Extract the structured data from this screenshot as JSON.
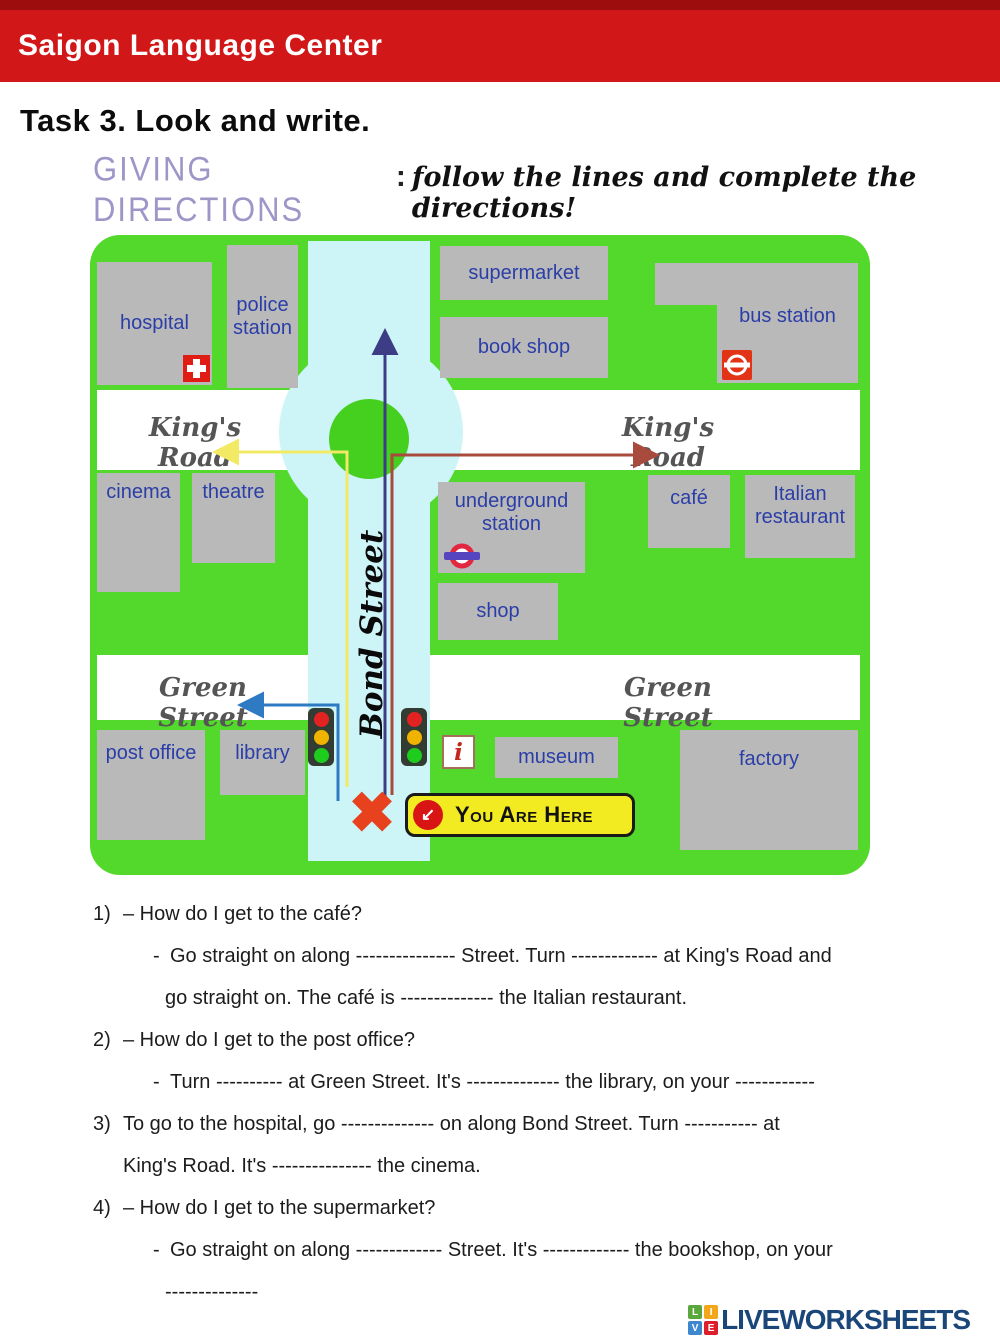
{
  "header": {
    "school_name": "Saigon Language Center"
  },
  "task": {
    "title": "Task 3. Look and write."
  },
  "intro": {
    "heading": "GIVING DIRECTIONS",
    "colon": ":",
    "script": "follow the lines and complete the directions!"
  },
  "map": {
    "streets": {
      "kings_road": "King's Road",
      "green_street": "Green Street",
      "bond_street": "Bond Street"
    },
    "buildings": {
      "hospital": "hospital",
      "police_station": "police station",
      "supermarket": "supermarket",
      "book_shop": "book shop",
      "bus_station": "bus station",
      "cinema": "cinema",
      "theatre": "theatre",
      "underground_station": "underground station",
      "shop": "shop",
      "cafe": "café",
      "italian_restaurant": "Italian restaurant",
      "post_office": "post office",
      "library": "library",
      "museum": "museum",
      "factory": "factory"
    },
    "you_are_here_label": "You Are Here",
    "icons": {
      "x_marker_glyph": "✖",
      "you_are_here_arrow_glyph": "↙",
      "info_letter": "i"
    },
    "colors": {
      "map_green": "#53d92b",
      "roundabout_green": "#45cf1f",
      "bond_street_blue": "#cdf4f7",
      "building_gray": "#b9b9b9",
      "building_label_blue": "#2b3ea8",
      "street_label_gray": "#555555",
      "arrow_yellow": "#f2e964",
      "arrow_blue": "#2e7bc4",
      "arrow_purple": "#3d3d85",
      "arrow_red": "#a84a3c",
      "header_red": "#d11717",
      "banner_yellow": "#f3eb21",
      "x_marker_red": "#e7411e"
    }
  },
  "questions": {
    "rows": [
      {
        "marker": "1)",
        "text": "– How do I get to the café?"
      },
      {
        "marker": "-",
        "text": "Go straight on along --------------- Street. Turn ------------- at King's Road and"
      },
      {
        "marker": "",
        "text": "go straight on. The café is -------------- the Italian restaurant."
      },
      {
        "marker": "2)",
        "text": "– How do I get to the post office?"
      },
      {
        "marker": "-",
        "text": "Turn ---------- at Green Street. It's -------------- the library, on your ------------"
      },
      {
        "marker": "3)",
        "text": "To go to the hospital, go -------------- on along Bond Street. Turn ----------- at"
      },
      {
        "marker": "",
        "text": "King's Road. It's --------------- the cinema."
      },
      {
        "marker": "4)",
        "text": "– How do I get to the supermarket?"
      },
      {
        "marker": "-",
        "text": "Go straight on along ------------- Street. It's ------------- the bookshop, on your"
      },
      {
        "marker": "",
        "text": "--------------"
      }
    ]
  },
  "footer": {
    "brand": "LIVEWORKSHEETS",
    "logo_letters": {
      "l": "L",
      "i": "I",
      "v": "V",
      "e": "E"
    }
  }
}
